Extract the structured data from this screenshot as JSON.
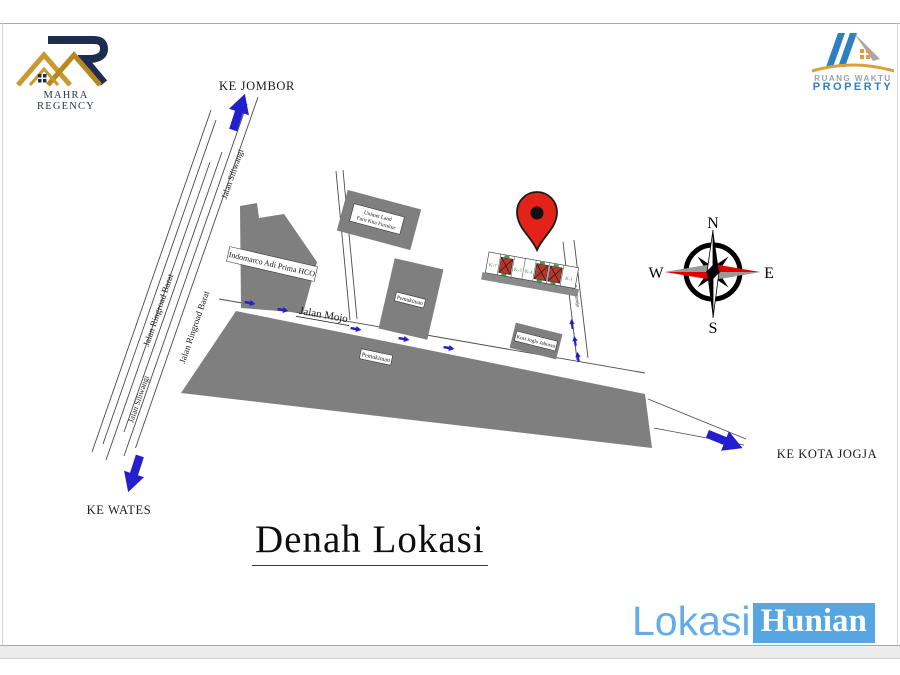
{
  "page": {
    "title_text": "Denah Lokasi",
    "footer_lokasi": "Lokasi",
    "footer_hunian": "Hunian"
  },
  "branding": {
    "mahra_name": "MAHRA REGENCY",
    "rw_line1": "RUANG WAKTU",
    "rw_line2": "PROPERTY"
  },
  "directions": {
    "north_label": "KE JOMBOR",
    "southwest_label": "KE WATES",
    "southeast_label": "KE KOTA JOGJA"
  },
  "roads": {
    "ringroad": "Jalan Ringroad Barat",
    "siliwangi": "Jalan Siliwangi",
    "mojo": "Jalan Mojo",
    "side_road": "Jl. Sidorejo"
  },
  "places": {
    "indomarco": "Indomarco Adi Prima HCO",
    "unimet_line1": "Unimet Land",
    "unimet_line2": "Furn Kita Furnitur",
    "pemukiman": "Pemukiman",
    "kost": "Kost Joglo Jaburan"
  },
  "site": {
    "lots": [
      "K-7",
      "K-3",
      "K-4",
      "K-1"
    ]
  },
  "compass": {
    "n": "N",
    "e": "E",
    "s": "S",
    "w": "W"
  },
  "colors": {
    "block_gray": "#7f7f7f",
    "road_stroke": "#4a4a4a",
    "arrow_blue": "#2220cd",
    "pin_red": "#e32219",
    "footer_blue": "#55a6e3",
    "footer_text_blue": "#62acea",
    "lot_green": "#2e9e3e",
    "house_red": "#b5372c",
    "compass_red": "#e00000",
    "logo_gold": "#c9982e",
    "logo_navy": "#1e2d4f",
    "rw_blue": "#2e7fc2"
  }
}
